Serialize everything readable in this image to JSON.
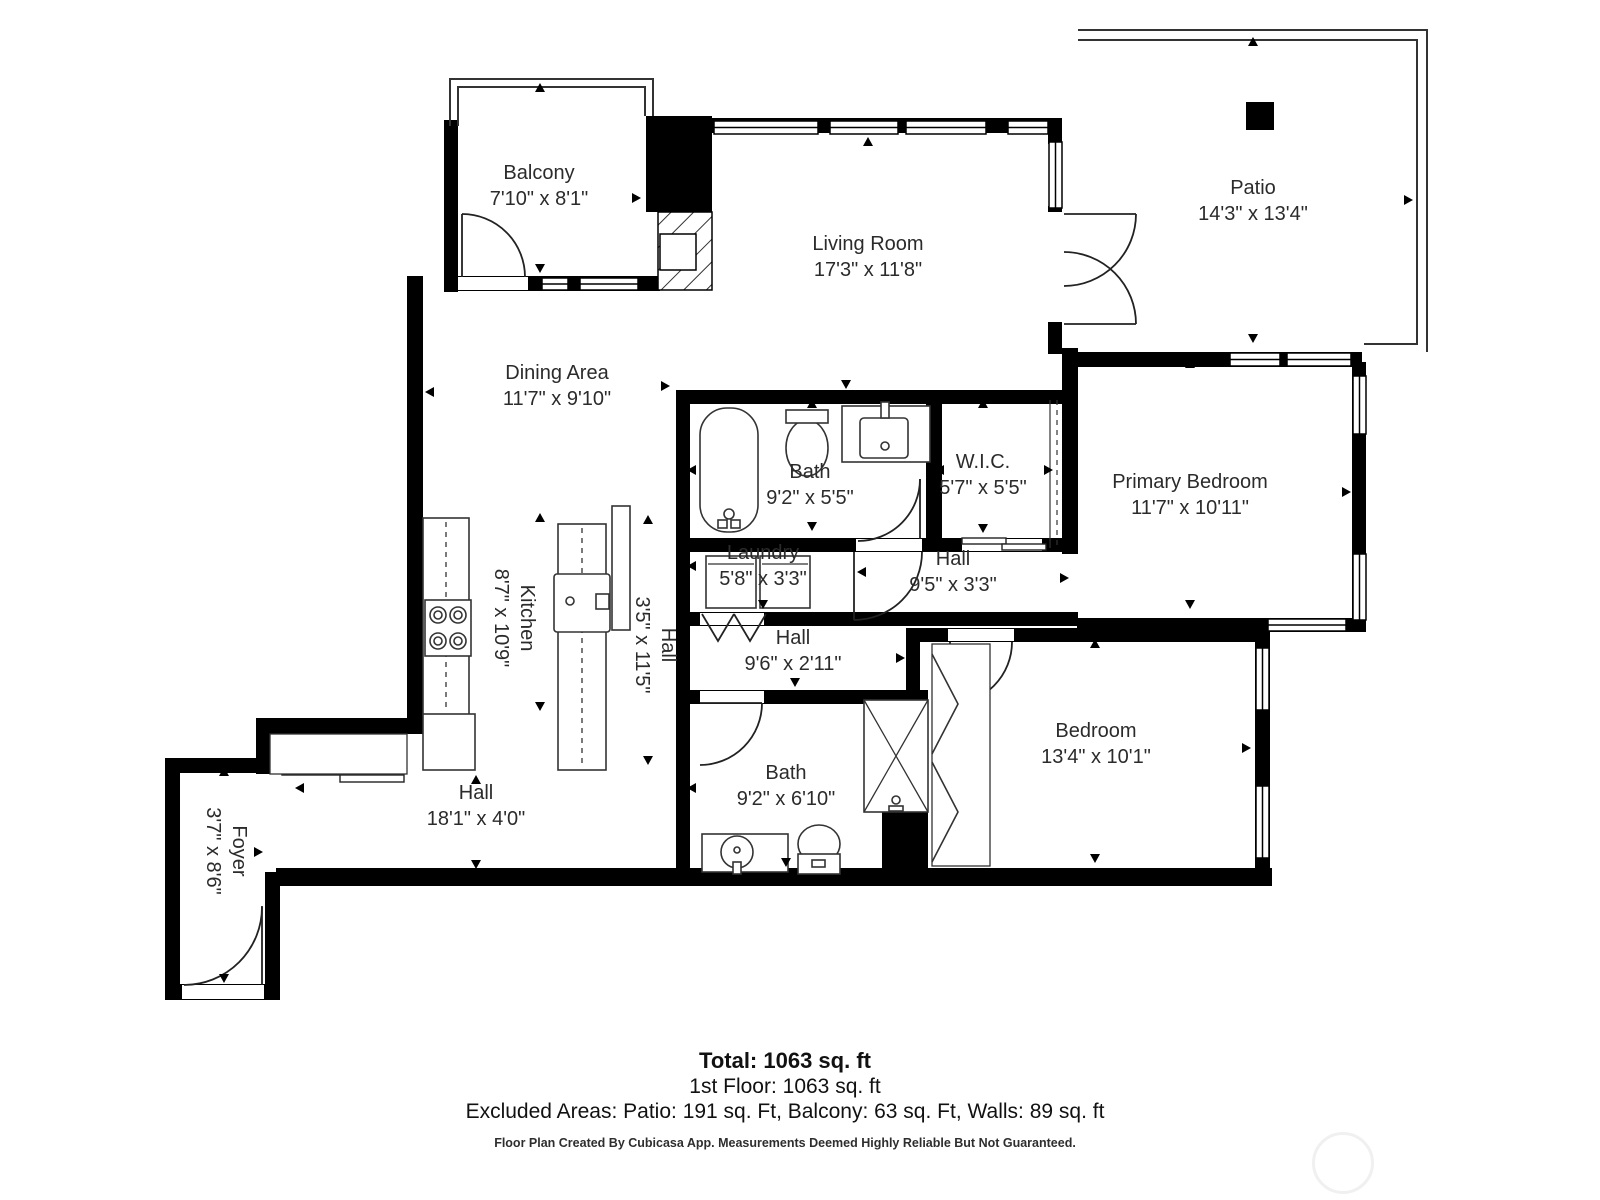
{
  "rooms": [
    {
      "name": "Balcony",
      "dims": "7'10\" x 8'1\""
    },
    {
      "name": "Living Room",
      "dims": "17'3\" x 11'8\""
    },
    {
      "name": "Patio",
      "dims": "14'3\" x 13'4\""
    },
    {
      "name": "Dining Area",
      "dims": "11'7\" x 9'10\""
    },
    {
      "name": "Bath",
      "dims": "9'2\" x 5'5\""
    },
    {
      "name": "W.I.C.",
      "dims": "5'7\" x 5'5\""
    },
    {
      "name": "Primary Bedroom",
      "dims": "11'7\" x 10'11\""
    },
    {
      "name": "Laundry",
      "dims": "5'8\" x 3'3\""
    },
    {
      "name": "Hall",
      "dims": "9'5\" x 3'3\""
    },
    {
      "name": "Kitchen",
      "dims": "8'7\" x 10'9\""
    },
    {
      "name": "Hall",
      "dims": "3'5\" x 11'5\""
    },
    {
      "name": "Hall",
      "dims": "9'6\" x 2'11\""
    },
    {
      "name": "Bath",
      "dims": "9'2\" x 6'10\""
    },
    {
      "name": "Bedroom",
      "dims": "13'4\" x 10'1\""
    },
    {
      "name": "Hall",
      "dims": "18'1\" x 4'0\""
    },
    {
      "name": "Foyer",
      "dims": "3'7\" x 8'6\""
    }
  ],
  "summary": {
    "total": "Total: 1063 sq. ft",
    "first_floor": "1st Floor: 1063 sq. ft",
    "excluded": "Excluded Areas: Patio: 191 sq. Ft, Balcony: 63 sq. Ft, Walls: 89 sq. ft"
  },
  "footer": "Floor Plan Created By Cubicasa App. Measurements Deemed Highly Reliable But Not Guaranteed.",
  "colors": {
    "wall": "#000000",
    "line": "#2a2a2a",
    "label": "#2b2b2b"
  }
}
